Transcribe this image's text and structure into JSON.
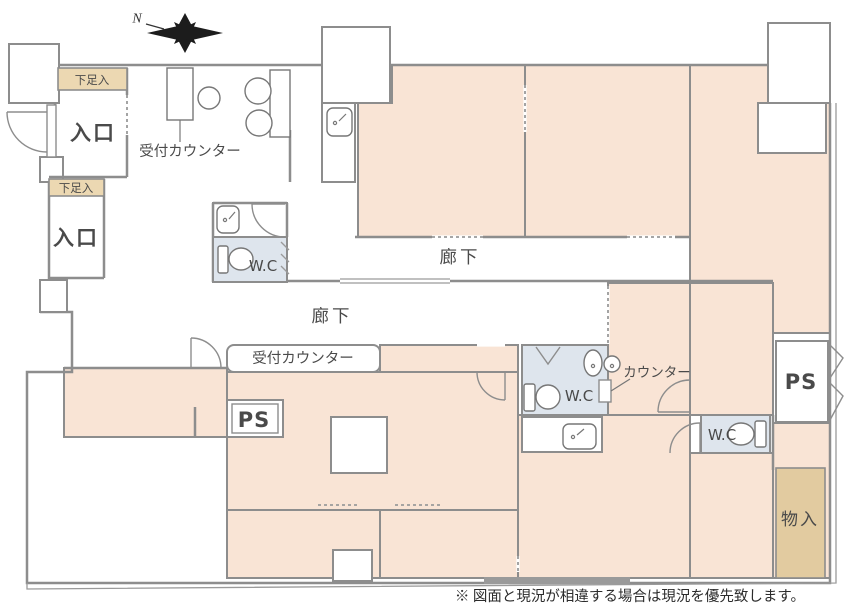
{
  "floorplan": {
    "compass": {
      "north_label": "N"
    },
    "labels": {
      "shoe1": "下足入",
      "shoe2": "下足入",
      "entrance1": "入口",
      "entrance2": "入口",
      "reception1": "受付カウンター",
      "reception2": "受付カウンター",
      "corridor1": "廊下",
      "corridor2": "廊下",
      "wc1": "W.C",
      "wc2": "W.C",
      "wc3": "W.C",
      "counter": "カウンター",
      "ps1": "PS",
      "ps2": "PS",
      "storage": "物入"
    },
    "note": "※ 図面と現況が相違する場合は現況を優先致します。",
    "colors": {
      "room_peach": "#f9e4d5",
      "shoe_beige": "#ecd8b2",
      "storage_beige": "#e2cba0",
      "wc_blue": "#dee5ed",
      "wall_gray": "#8d8d8d",
      "compass_black": "#1c1c1c"
    }
  }
}
